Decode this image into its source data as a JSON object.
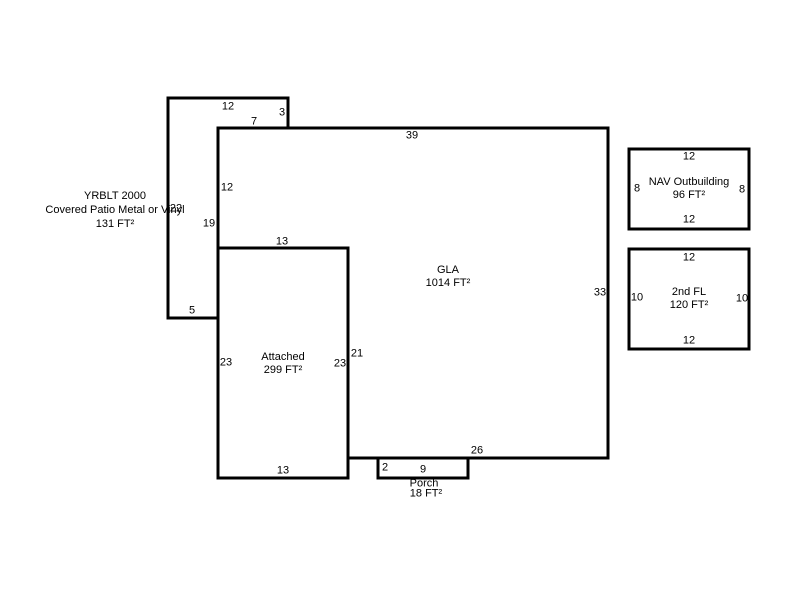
{
  "patio": {
    "name_line1": "YRBLT 2000",
    "name_line2": "Covered Patio Metal or Vinyl",
    "area": "131 FT²",
    "dim_top": "12",
    "dim_step_right": "3",
    "dim_step_top": "7",
    "dim_left": "22",
    "dim_right": "19",
    "dim_bottom": "5"
  },
  "gla": {
    "name": "GLA",
    "area": "1014 FT²",
    "dim_top": "39",
    "dim_left_upper": "12",
    "dim_notch_top": "13",
    "dim_notch_right": "21",
    "dim_right": "33",
    "dim_bottom": "26"
  },
  "attached": {
    "name": "Attached",
    "area": "299 FT²",
    "dim_left": "23",
    "dim_right": "23",
    "dim_bottom": "13"
  },
  "porch": {
    "name": "Porch",
    "area": "18 FT²",
    "dim_left": "2",
    "dim_top": "9"
  },
  "nav_outbuilding": {
    "name": "NAV Outbuilding",
    "area": "96 FT²",
    "dim_top": "12",
    "dim_left": "8",
    "dim_right": "8",
    "dim_bottom": "12"
  },
  "second_floor": {
    "name": "2nd FL",
    "area": "120 FT²",
    "dim_top": "12",
    "dim_left": "10",
    "dim_right": "10",
    "dim_bottom": "12"
  },
  "colors": {
    "line": "#000000",
    "background": "#ffffff",
    "text": "#000000"
  }
}
